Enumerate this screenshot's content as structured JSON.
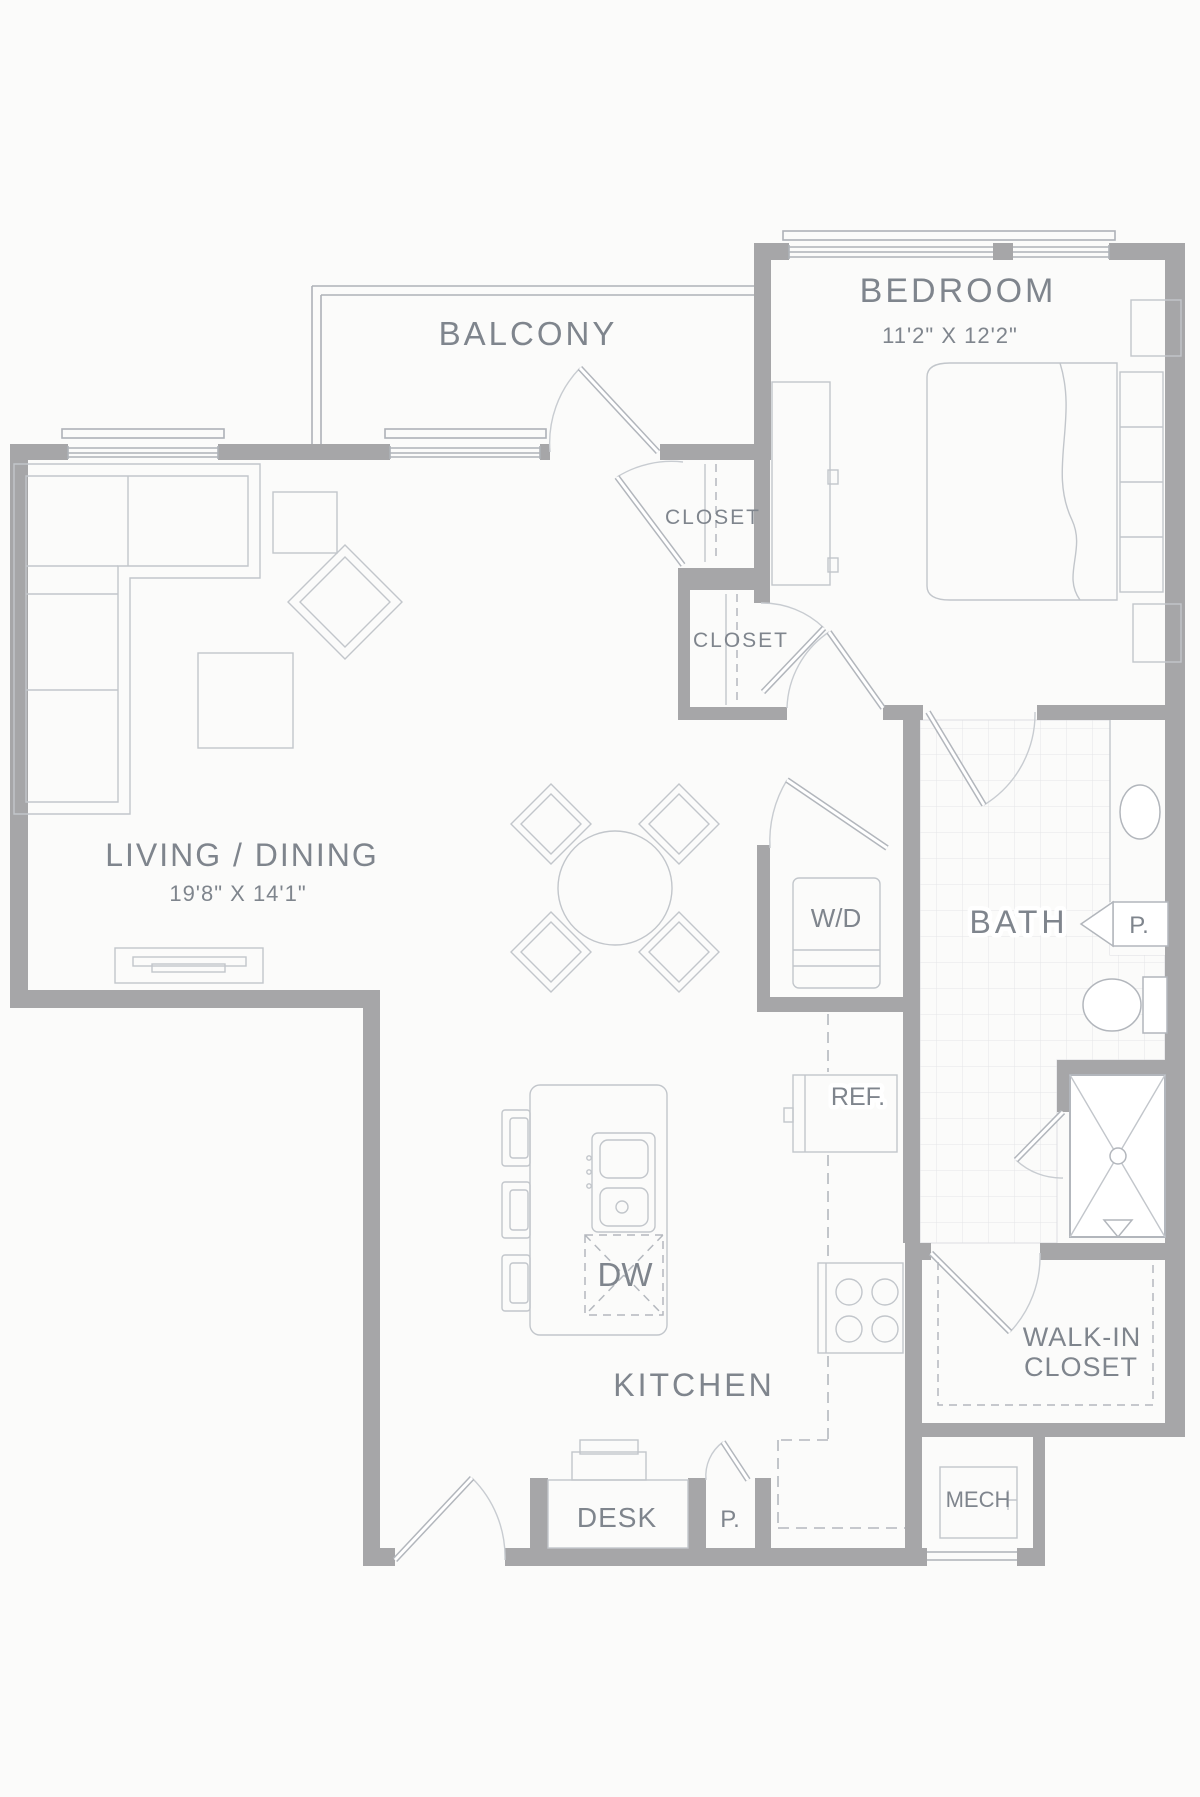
{
  "rooms": {
    "balcony": {
      "label": "BALCONY"
    },
    "bedroom": {
      "label": "BEDROOM",
      "dims": "11'2\" X 12'2\""
    },
    "living_dining": {
      "label": "LIVING / DINING",
      "dims": "19'8\" X 14'1\""
    },
    "closet_upper": {
      "label": "CLOSET"
    },
    "closet_lower": {
      "label": "CLOSET"
    },
    "bath": {
      "label": "BATH"
    },
    "walk_in_closet": {
      "line1": "WALK-IN",
      "line2": "CLOSET"
    },
    "kitchen": {
      "label": "KITCHEN"
    }
  },
  "fixtures": {
    "washer_dryer": "W/D",
    "bath_cabinet": "P.",
    "refrigerator": "REF.",
    "dishwasher": "DW",
    "desk": "DESK",
    "pantry": "P.",
    "mechanical": "MECH"
  },
  "colors": {
    "wall": "#a6a6a8",
    "line": "#b2b6bc",
    "line_light": "#c8ccd1",
    "tile": "#e4e6e8",
    "text": "#7f858d",
    "background": "#fbfbfa"
  }
}
